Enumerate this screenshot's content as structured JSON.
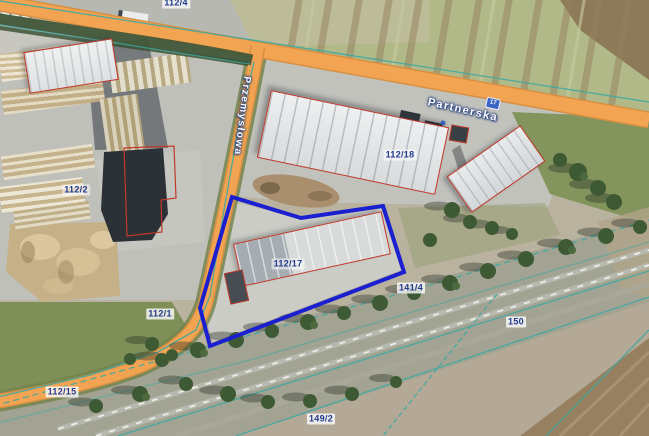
{
  "map": {
    "view": "satellite-cadastral",
    "roads": [
      {
        "name": "Przemysłowa"
      },
      {
        "name": "Partnerska"
      }
    ],
    "address_badge": "17",
    "highlighted_parcel": "112/17",
    "parcels": [
      {
        "label": "112/4"
      },
      {
        "label": "112/2"
      },
      {
        "label": "112/18"
      },
      {
        "label": "112/17"
      },
      {
        "label": "112/1"
      },
      {
        "label": "112/15"
      },
      {
        "label": "141/4"
      },
      {
        "label": "150"
      },
      {
        "label": "149/2"
      }
    ],
    "colors": {
      "road_fill": "#f2a452",
      "highlight_outline": "#1a1fd0",
      "cadastral_line": "#3fa8a2",
      "building_outline": "#c0392b",
      "label_text": "#21398f"
    }
  }
}
